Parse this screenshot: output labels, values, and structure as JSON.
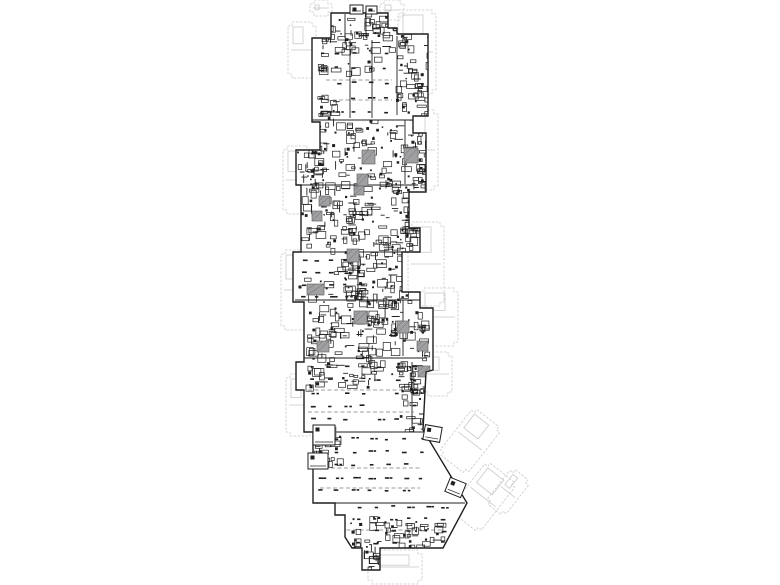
{
  "meta": {
    "kind": "architectural-floor-plan",
    "description_visible_text": "",
    "width": 780,
    "height": 585
  },
  "colors": {
    "background": "#ffffff",
    "ink": "#1f1f1f",
    "ink_soft": "#4a4a4a",
    "core_fill": "#a0a0a3",
    "core_stroke": "#68686c",
    "ghost": "#c9c9cd",
    "lane": "#7d7d80"
  },
  "plan": {
    "perimeter": [
      [
        331,
        13
      ],
      [
        388,
        13
      ],
      [
        388,
        28
      ],
      [
        397,
        28
      ],
      [
        397,
        34
      ],
      [
        428,
        34
      ],
      [
        428,
        116
      ],
      [
        413,
        116
      ],
      [
        413,
        133
      ],
      [
        426,
        133
      ],
      [
        426,
        192
      ],
      [
        409,
        192
      ],
      [
        409,
        228
      ],
      [
        420,
        228
      ],
      [
        420,
        252
      ],
      [
        402,
        252
      ],
      [
        402,
        292
      ],
      [
        420,
        292
      ],
      [
        420,
        308
      ],
      [
        433,
        308
      ],
      [
        433,
        370
      ],
      [
        426,
        372
      ],
      [
        423,
        430
      ],
      [
        467,
        503
      ],
      [
        443,
        548
      ],
      [
        380,
        548
      ],
      [
        380,
        570
      ],
      [
        362,
        570
      ],
      [
        362,
        548
      ],
      [
        352,
        548
      ],
      [
        345,
        537
      ],
      [
        345,
        515
      ],
      [
        335,
        515
      ],
      [
        335,
        503
      ],
      [
        313,
        503
      ],
      [
        313,
        432
      ],
      [
        304,
        432
      ],
      [
        304,
        390
      ],
      [
        296,
        390
      ],
      [
        296,
        362
      ],
      [
        304,
        362
      ],
      [
        304,
        302
      ],
      [
        293,
        302
      ],
      [
        293,
        252
      ],
      [
        301,
        252
      ],
      [
        301,
        185
      ],
      [
        296,
        185
      ],
      [
        296,
        150
      ],
      [
        320,
        150
      ],
      [
        320,
        122
      ],
      [
        312,
        122
      ],
      [
        312,
        38
      ],
      [
        331,
        38
      ]
    ],
    "partitions": [
      [
        312,
        120,
        413,
        120
      ],
      [
        301,
        185,
        418,
        185
      ],
      [
        301,
        252,
        418,
        252
      ],
      [
        295,
        300,
        420,
        300
      ],
      [
        296,
        358,
        426,
        358
      ],
      [
        305,
        432,
        430,
        432
      ],
      [
        313,
        503,
        465,
        503
      ],
      [
        350,
        40,
        350,
        118
      ],
      [
        372,
        40,
        372,
        118
      ],
      [
        358,
        255,
        358,
        300
      ],
      [
        397,
        36,
        397,
        115
      ],
      [
        405,
        120,
        405,
        184
      ],
      [
        403,
        300,
        403,
        356
      ],
      [
        412,
        362,
        412,
        430
      ],
      [
        345,
        14,
        345,
        38
      ],
      [
        366,
        14,
        366,
        38
      ]
    ],
    "lanes": [
      [
        308,
        390,
        414,
        390
      ],
      [
        308,
        412,
        414,
        412
      ],
      [
        318,
        468,
        420,
        468
      ],
      [
        320,
        488,
        420,
        488
      ],
      [
        340,
        530,
        444,
        530
      ],
      [
        326,
        80,
        392,
        80
      ],
      [
        326,
        100,
        392,
        100
      ]
    ],
    "clusters": [
      {
        "x": 315,
        "y": 14,
        "w": 80,
        "h": 34,
        "count": 60,
        "seed": 11
      },
      {
        "x": 396,
        "y": 34,
        "w": 32,
        "h": 80,
        "count": 55,
        "seed": 12
      },
      {
        "x": 302,
        "y": 118,
        "w": 122,
        "h": 66,
        "count": 150,
        "seed": 13
      },
      {
        "x": 301,
        "y": 186,
        "w": 116,
        "h": 66,
        "count": 150,
        "seed": 14
      },
      {
        "x": 340,
        "y": 252,
        "w": 74,
        "h": 52,
        "count": 90,
        "seed": 15
      },
      {
        "x": 306,
        "y": 300,
        "w": 122,
        "h": 58,
        "count": 140,
        "seed": 16
      },
      {
        "x": 312,
        "y": 44,
        "w": 84,
        "h": 30,
        "count": 20,
        "seed": 17
      },
      {
        "x": 296,
        "y": 254,
        "w": 60,
        "h": 44,
        "count": 18,
        "seed": 18
      },
      {
        "x": 306,
        "y": 360,
        "w": 112,
        "h": 26,
        "count": 60,
        "seed": 19
      },
      {
        "x": 398,
        "y": 378,
        "w": 28,
        "h": 52,
        "count": 30,
        "seed": 20
      },
      {
        "x": 314,
        "y": 424,
        "w": 26,
        "h": 40,
        "count": 28,
        "seed": 21
      },
      {
        "x": 384,
        "y": 520,
        "w": 58,
        "h": 28,
        "count": 40,
        "seed": 22
      },
      {
        "x": 350,
        "y": 516,
        "w": 28,
        "h": 32,
        "count": 22,
        "seed": 23
      },
      {
        "x": 362,
        "y": 546,
        "w": 18,
        "h": 22,
        "count": 12,
        "seed": 24
      },
      {
        "x": 317,
        "y": 92,
        "w": 18,
        "h": 30,
        "count": 16,
        "seed": 25
      },
      {
        "x": 296,
        "y": 150,
        "w": 22,
        "h": 34,
        "count": 18,
        "seed": 26
      },
      {
        "x": 405,
        "y": 192,
        "w": 18,
        "h": 58,
        "count": 26,
        "seed": 27
      },
      {
        "x": 413,
        "y": 116,
        "w": 16,
        "h": 72,
        "count": 22,
        "seed": 28
      }
    ],
    "parking": [
      {
        "x": 320,
        "y": 52,
        "w": 74,
        "h": 64,
        "dx": 16,
        "dy": 15,
        "seed": 31
      },
      {
        "x": 302,
        "y": 260,
        "w": 54,
        "h": 38,
        "dx": 14,
        "dy": 12,
        "seed": 32
      },
      {
        "x": 310,
        "y": 366,
        "w": 104,
        "h": 62,
        "dx": 17,
        "dy": 13,
        "seed": 33
      },
      {
        "x": 318,
        "y": 438,
        "w": 102,
        "h": 62,
        "dx": 17,
        "dy": 13,
        "seed": 34
      },
      {
        "x": 340,
        "y": 506,
        "w": 104,
        "h": 38,
        "dx": 17,
        "dy": 12,
        "seed": 35
      }
    ],
    "cores": [
      {
        "x": 362,
        "y": 150,
        "w": 13,
        "h": 14
      },
      {
        "x": 404,
        "y": 148,
        "w": 14,
        "h": 15
      },
      {
        "x": 357,
        "y": 174,
        "w": 11,
        "h": 12
      },
      {
        "x": 319,
        "y": 196,
        "w": 11,
        "h": 10
      },
      {
        "x": 312,
        "y": 211,
        "w": 10,
        "h": 10
      },
      {
        "x": 347,
        "y": 249,
        "w": 12,
        "h": 13
      },
      {
        "x": 307,
        "y": 284,
        "w": 17,
        "h": 11
      },
      {
        "x": 354,
        "y": 311,
        "w": 13,
        "h": 13
      },
      {
        "x": 397,
        "y": 321,
        "w": 12,
        "h": 12
      },
      {
        "x": 317,
        "y": 341,
        "w": 12,
        "h": 11
      },
      {
        "x": 417,
        "y": 341,
        "w": 11,
        "h": 10
      },
      {
        "x": 418,
        "y": 366,
        "w": 12,
        "h": 11
      },
      {
        "x": 324,
        "y": 427,
        "w": 12,
        "h": 11
      },
      {
        "x": 354,
        "y": 186,
        "w": 10,
        "h": 9
      }
    ],
    "pods": [
      {
        "x": 424,
        "y": 426,
        "w": 17,
        "h": 15,
        "rot": 10
      },
      {
        "x": 447,
        "y": 480,
        "w": 17,
        "h": 15,
        "rot": 22
      },
      {
        "x": 350,
        "y": 5,
        "w": 13,
        "h": 9,
        "rot": 0
      },
      {
        "x": 366,
        "y": 6,
        "w": 11,
        "h": 8,
        "rot": 0
      },
      {
        "x": 308,
        "y": 453,
        "w": 20,
        "h": 16,
        "rot": 0
      },
      {
        "x": 313,
        "y": 425,
        "w": 22,
        "h": 20,
        "rot": 0
      }
    ],
    "ghosts": [
      {
        "x": 288,
        "y": 22,
        "w": 28,
        "h": 56,
        "rot": 0
      },
      {
        "x": 310,
        "y": 0,
        "w": 22,
        "h": 16,
        "rot": 0
      },
      {
        "x": 380,
        "y": 0,
        "w": 24,
        "h": 20,
        "rot": 0
      },
      {
        "x": 398,
        "y": 10,
        "w": 38,
        "h": 84,
        "rot": 0
      },
      {
        "x": 404,
        "y": 110,
        "w": 34,
        "h": 80,
        "rot": 0
      },
      {
        "x": 408,
        "y": 222,
        "w": 36,
        "h": 84,
        "rot": 0
      },
      {
        "x": 420,
        "y": 288,
        "w": 38,
        "h": 58,
        "rot": 0
      },
      {
        "x": 424,
        "y": 352,
        "w": 28,
        "h": 44,
        "rot": 0
      },
      {
        "x": 283,
        "y": 146,
        "w": 28,
        "h": 68,
        "rot": 0
      },
      {
        "x": 281,
        "y": 250,
        "w": 28,
        "h": 80,
        "rot": 0
      },
      {
        "x": 286,
        "y": 374,
        "w": 28,
        "h": 62,
        "rot": 0
      },
      {
        "x": 452,
        "y": 412,
        "w": 36,
        "h": 58,
        "rot": 38
      },
      {
        "x": 464,
        "y": 466,
        "w": 38,
        "h": 62,
        "rot": 38
      },
      {
        "x": 496,
        "y": 470,
        "w": 24,
        "h": 44,
        "rot": 38
      },
      {
        "x": 368,
        "y": 550,
        "w": 54,
        "h": 34,
        "rot": 0
      }
    ]
  }
}
